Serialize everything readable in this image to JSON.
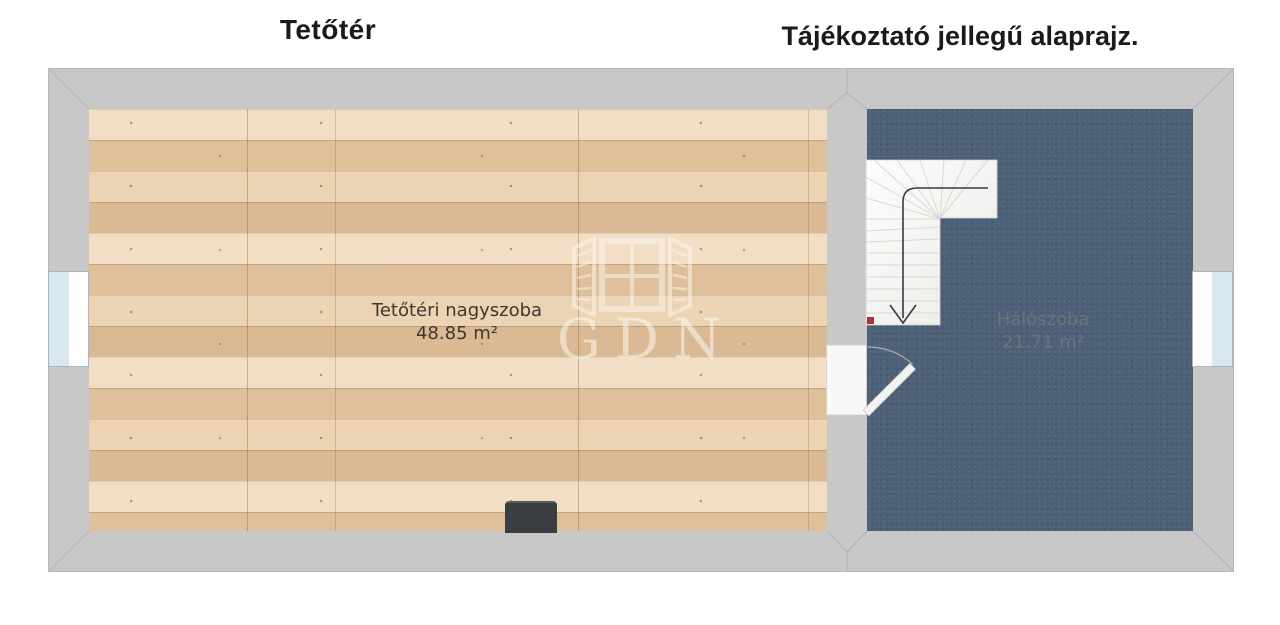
{
  "titles": {
    "left": "Tetőtér",
    "right": "Tájékoztató jellegű alaprajz."
  },
  "rooms": [
    {
      "name": "Tetőtéri nagyszoba",
      "area": "48.85 m²",
      "floor": "wood-planks"
    },
    {
      "name": "Hálószoba",
      "area": "21.71 m²",
      "floor": "dark-carpet"
    }
  ],
  "features": {
    "staircase": "l-shaped-winder-stairs-with-down-arrow",
    "stair_marker": "red-start-square",
    "door": "swing-door-between-rooms",
    "windows": [
      "left-wall-window",
      "right-wall-window"
    ],
    "stove": "dark-rectangular-object-on-bottom-wall"
  },
  "watermark": {
    "text": "GDN",
    "icon": "open-window-logo"
  },
  "colors": {
    "wall": "#c8c8c8",
    "wood_floor": "#e0c3a0",
    "bedroom_floor": "#4e6077",
    "stairs": "#f5f5f3",
    "window_glass": "#d7e8f0",
    "marker_red": "#a83434",
    "title_text": "#1a1a1a",
    "room_label_left": "#3f382e",
    "room_label_right": "#6d737b",
    "background": "#ffffff"
  }
}
